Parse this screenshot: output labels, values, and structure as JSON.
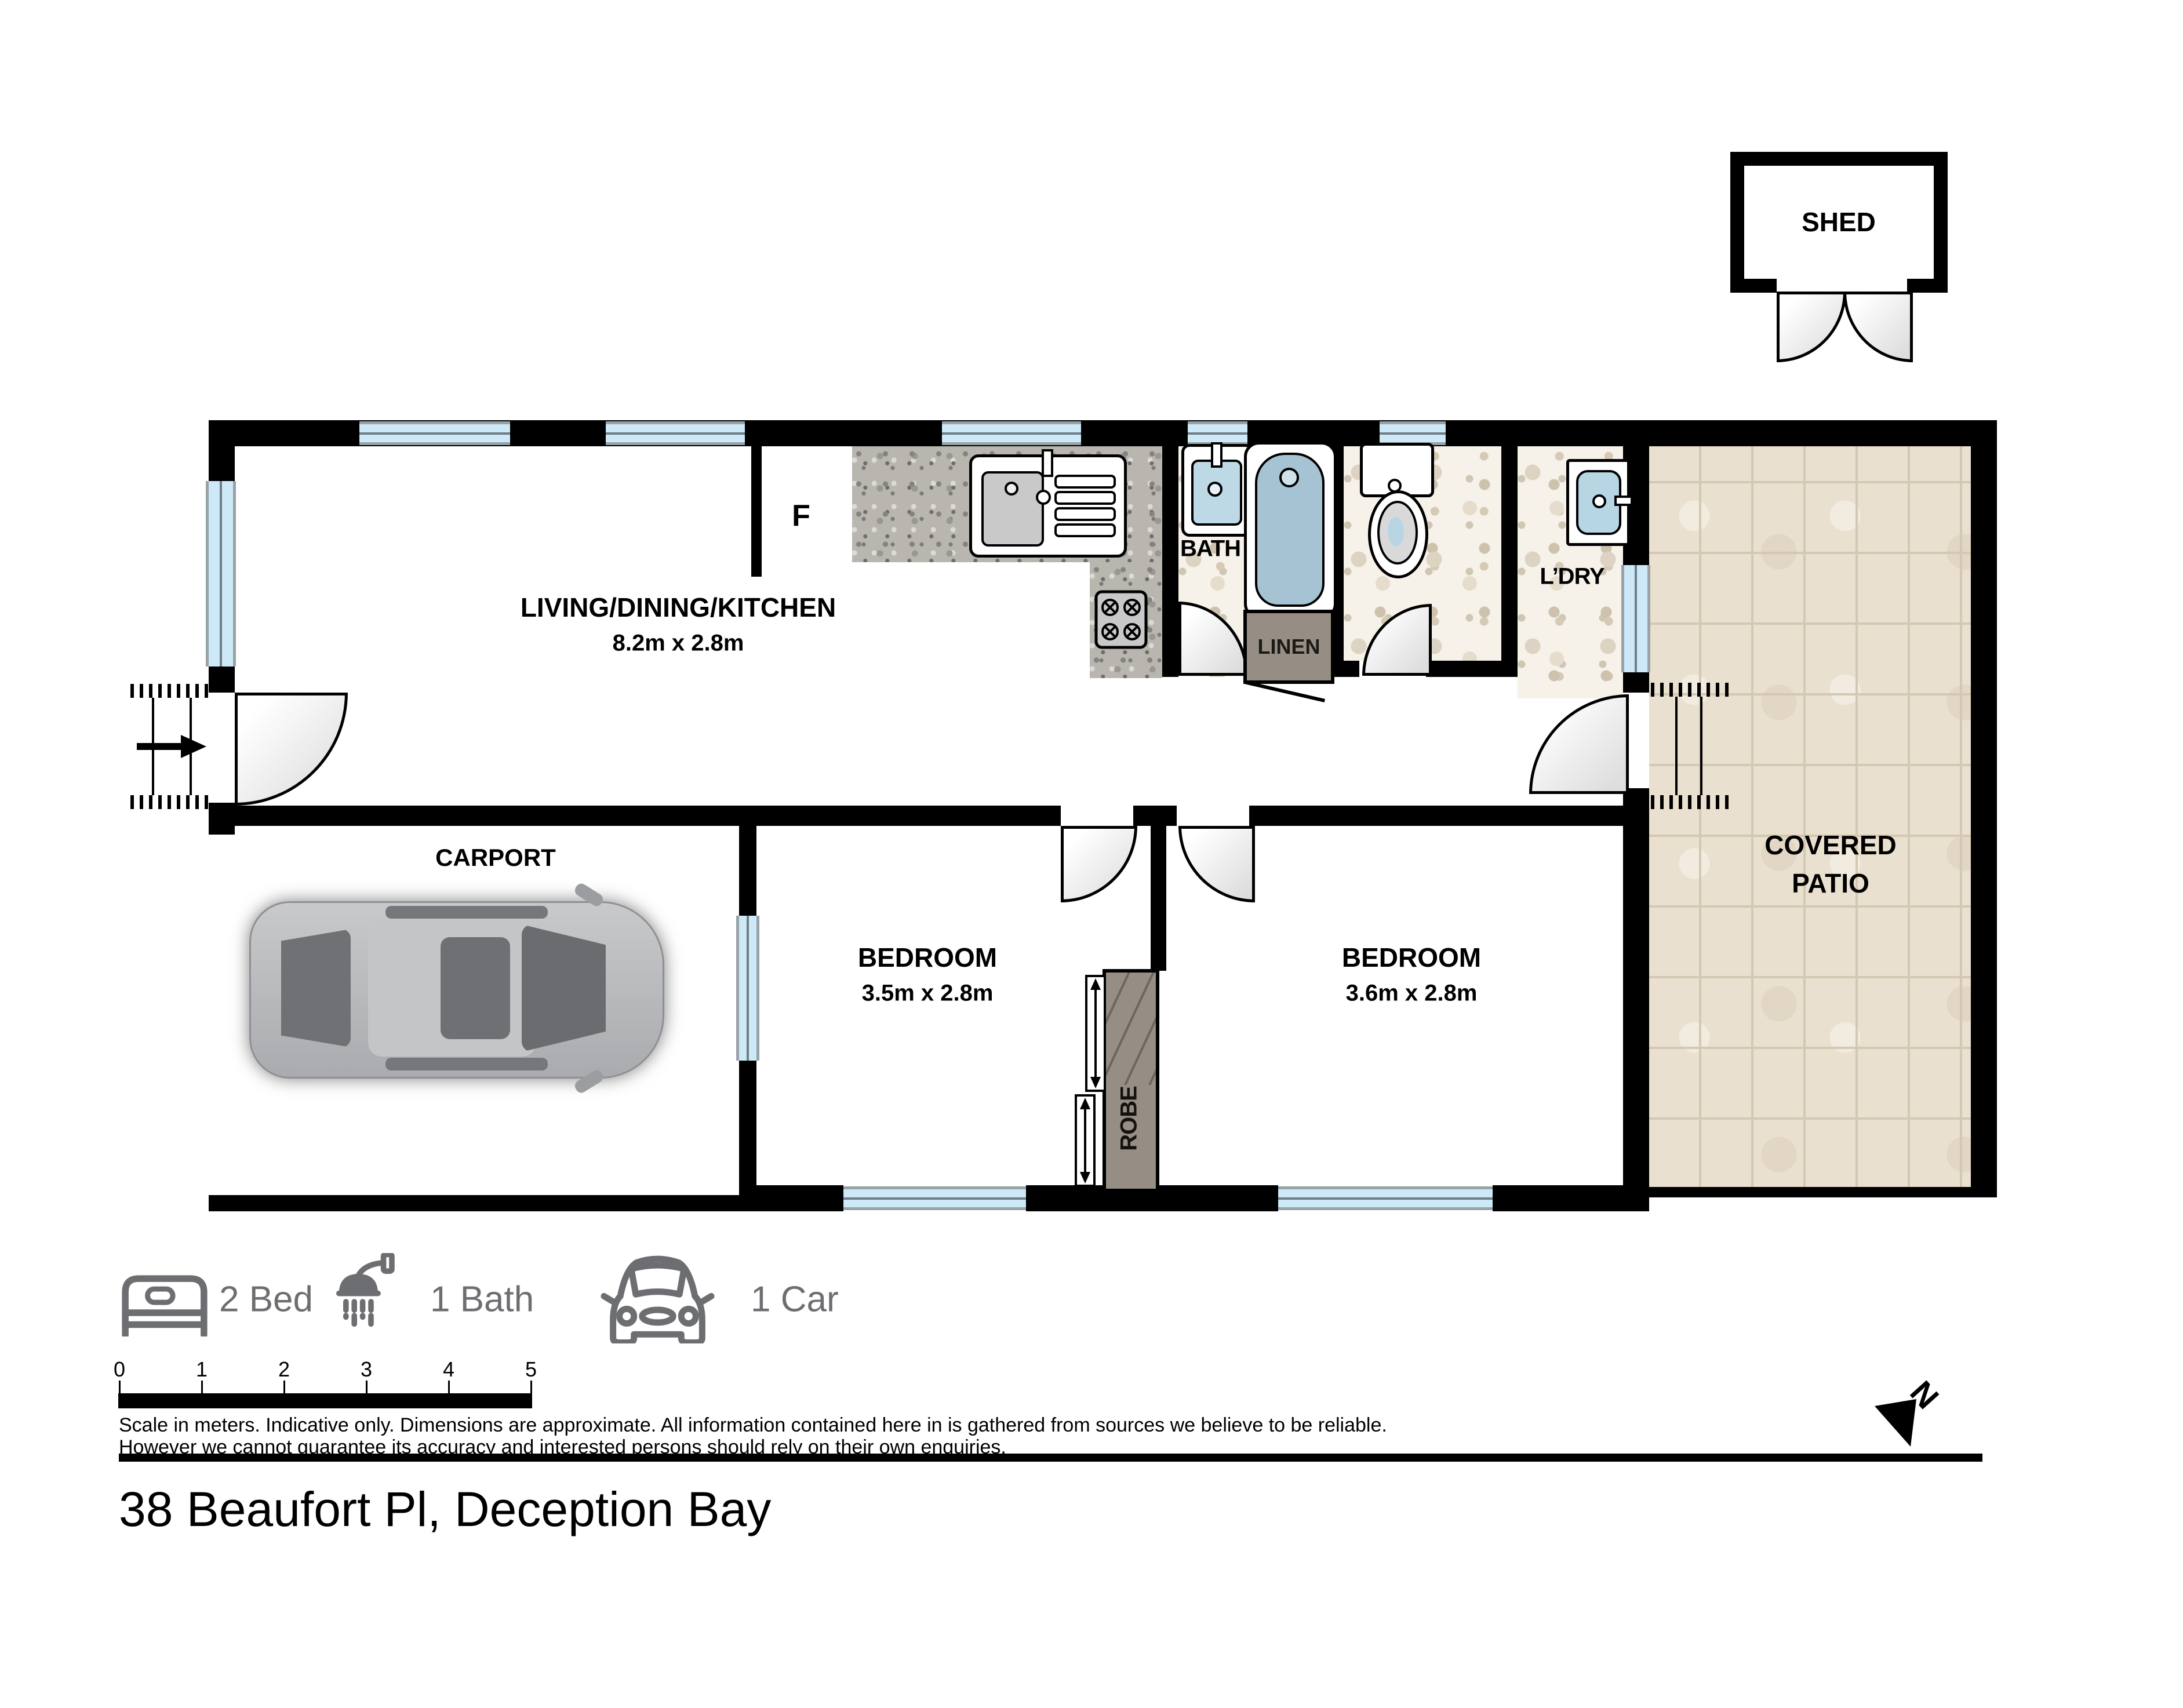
{
  "title": "38 Beaufort Pl, Deception Bay",
  "shed": {
    "label": "SHED"
  },
  "rooms": {
    "living": {
      "label": "LIVING/DINING/KITCHEN",
      "dims": "8.2m x 2.8m"
    },
    "carport": {
      "label": "CARPORT"
    },
    "bedroom1": {
      "label": "BEDROOM",
      "dims": "3.5m x 2.8m"
    },
    "bedroom2": {
      "label": "BEDROOM",
      "dims": "3.6m x 2.8m"
    },
    "bath": {
      "label": "BATH"
    },
    "linen": {
      "label": "LINEN"
    },
    "laundry": {
      "label": "L’DRY"
    },
    "robe": {
      "label": "ROBE"
    },
    "patio": {
      "line1": "COVERED",
      "line2": "PATIO"
    },
    "fridge": {
      "label": "F"
    }
  },
  "legend": {
    "items": [
      {
        "icon": "bed-icon",
        "label": "2 Bed"
      },
      {
        "icon": "shower-icon",
        "label": "1 Bath"
      },
      {
        "icon": "car-icon",
        "label": "1 Car"
      }
    ]
  },
  "scale_bar": {
    "ticks": [
      "0",
      "1",
      "2",
      "3",
      "4",
      "5"
    ]
  },
  "disclaimer": {
    "line1": "Scale in meters. Indicative only. Dimensions are approximate. All information contained here in is gathered from sources we believe to be reliable.",
    "line2": "However we cannot guarantee its accuracy and interested persons should rely on their own enquiries."
  },
  "north": {
    "label": "N"
  },
  "colors": {
    "wall": "#000000",
    "window": "#cde9f8",
    "patio_tile": "#eae0cf",
    "granite": "#b9b6b0",
    "linen_grey": "#968e84",
    "legend_grey": "#6d6e71"
  }
}
